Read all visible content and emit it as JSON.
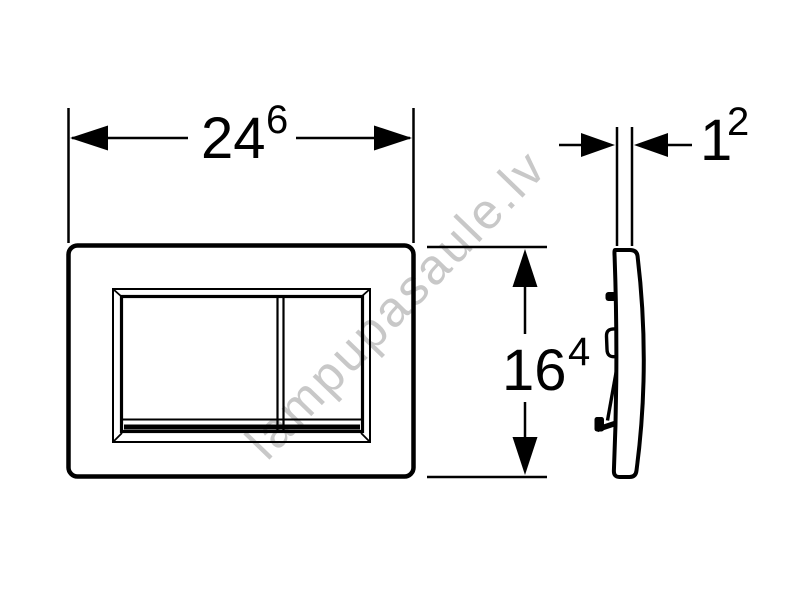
{
  "page": {
    "background_color": "#ffffff"
  },
  "watermark": {
    "text": "lampupasaule.lv",
    "color": "#c8c8c8",
    "rotation_deg": -46
  },
  "drawing": {
    "type": "technical-dimension-drawing",
    "subject": "flush-plate-with-two-buttons",
    "line_color": "#000000",
    "fill_color": "#ffffff"
  },
  "dimensions": {
    "width": {
      "value": "24",
      "superscript": "6"
    },
    "depth": {
      "value": "1",
      "superscript": "2"
    },
    "height": {
      "value": "16",
      "superscript": "4"
    }
  }
}
